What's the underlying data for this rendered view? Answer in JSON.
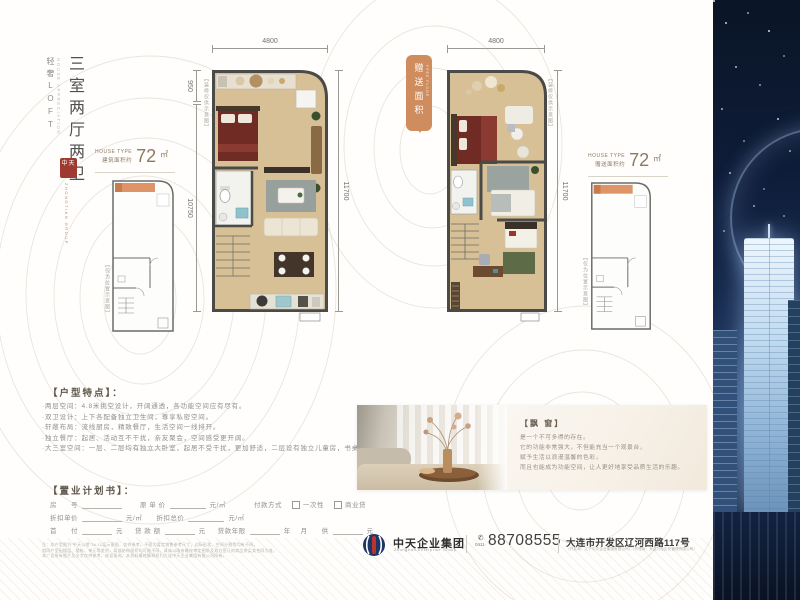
{
  "sidebar": {
    "series": "轻奢LOFT",
    "series_en": "HOUSE APPRECIATION",
    "title": "三室两厅两卫",
    "seal": "中天",
    "seal_caption": "ZHONGTIAN GROUP"
  },
  "plan1": {
    "type_en": "HOUSE TYPE",
    "area_label": "建筑面积约",
    "area_value": "72",
    "area_unit": "㎡",
    "dim_top": "4800",
    "dim_left_upper": "950",
    "dim_left_lower": "10750",
    "dim_right": "11700",
    "deco_note": "【装修仅供示意图】",
    "keyplan_note": "【仅为位置示意图】"
  },
  "plan2": {
    "type_en": "HOUSE TYPE",
    "area_label": "赠送面积约",
    "area_value": "72",
    "area_unit": "㎡",
    "dim_top": "4800",
    "dim_right": "11700",
    "deco_note": "【装修仅供示意图】",
    "keyplan_note": "【仅为位置示意图】",
    "badge": "赠送面积",
    "badge_en": "FREE FLOOR"
  },
  "features": {
    "heading": "【户型特点】：",
    "items": [
      "·两层空间：4.8米挑空设计，开阔通透，各功能空间应有尽有。",
      "·双卫设计：上下各配备独立卫生间，尊享私密空间。",
      "·轩敞布局：流线厨房，精致餐厅，生活空间一线排开。",
      "·独立餐厅：起居、活动互不干扰，亲友聚会，空间感受更开阔。",
      "·大三室空间：一层、二层均有独立大卧室，起居不受干扰，更加舒适，二层设有独立儿童房，书桌设计，合理布局。"
    ]
  },
  "purchase": {
    "heading": "【置业计划书】：",
    "row1": {
      "l1": "房　　号",
      "l2": "原 单 价",
      "u2": "元/㎡",
      "pay": "付款方式",
      "opt1": "一次性",
      "opt2": "商业贷"
    },
    "row2": {
      "l1": "折扣单价",
      "u1": "元/㎡",
      "l2": "折扣总价",
      "u2": "元/㎡"
    },
    "row3": {
      "l1": "首　　付",
      "u1": "元",
      "l2": "贷 款 额",
      "u2": "元",
      "l3": "贷款年限",
      "u3": "年",
      "l4": "月　　供",
      "u4": "元"
    },
    "disclaimer": [
      "注：本户型图为“中天公馆”3#-11层示意图，仅供参考。平面为暂定销售参考尺寸，边际形状、空间分割等均有不同，",
      "相同户型因楼层、楼栋、单元等差别，局部结构面积均可能不同，具体以政府最终审定图纸及双方签订的商品房买卖合同为准。",
      "本广告所有图片及文字仅供参考，欢迎垂询。本资料最终解释权归大连中天企业集团有限公司所有。"
    ]
  },
  "gallery": {
    "title": "【飘 窗】",
    "lines": [
      "是一个不可多得的存在。",
      "它的功能非常强大，不但能充当一个观景台，",
      "赋予生活以浪漫温馨的色彩，",
      "而且也能成为功能空间，让人更好地享受品质生活的乐趣。"
    ]
  },
  "footer": {
    "company": "中天企业集团",
    "company_en": "Zhongtian Enterprise Group",
    "phone_icon": "✆",
    "phone_area": "0411·",
    "phone": "88708555",
    "address": "大连市开发区辽河西路117号",
    "address_note": "（开发商：辽宁中天企业集团有限公司）（代理商：大连万怡企业管理有限公司）"
  },
  "colors": {
    "accent_orange": "#cf8c5e",
    "bronze": "#8d7a62",
    "seal_red": "#9e3a2f",
    "floor_tan": "#d8c096",
    "night_navy": "#0d1b33"
  }
}
